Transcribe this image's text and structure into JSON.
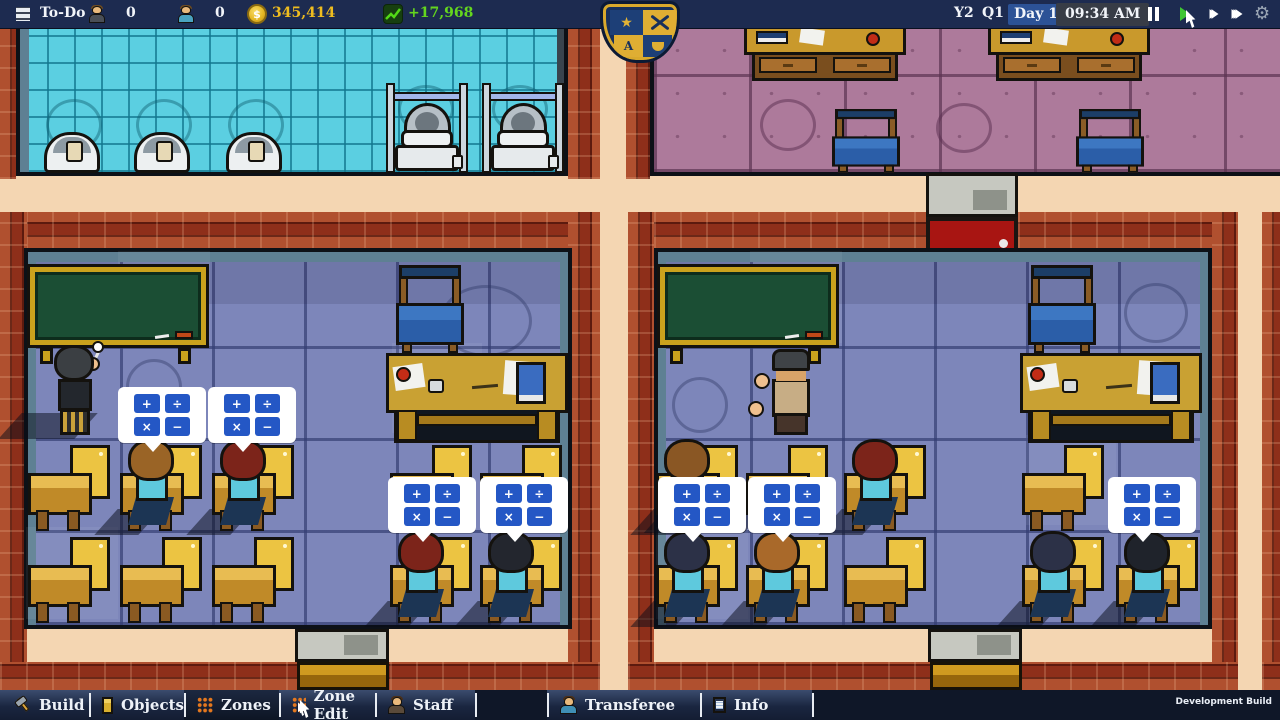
{
  "topbar": {
    "todo_label": "To-Do",
    "teachers_count": "0",
    "students_count": "0",
    "currency_symbol": "$",
    "money": "345,414",
    "income": "+17,968",
    "year": "Y2",
    "quarter": "Q1",
    "day": "Day 1",
    "time": "09:34 AM"
  },
  "toolbar": {
    "active_tab": "Zones",
    "dev_label": "Development Build",
    "tabs": [
      {
        "label": "Build",
        "icon": "hammer-icon"
      },
      {
        "label": "Objects",
        "icon": "cabinet-icon"
      },
      {
        "label": "Zones",
        "icon": "zones-grid-icon"
      },
      {
        "label": "Zone Edit",
        "icon": "zone-edit-icon"
      },
      {
        "label": "Staff",
        "icon": "staff-icon"
      },
      {
        "label": "Transferee",
        "icon": "transferee-icon"
      },
      {
        "label": "Info",
        "icon": "info-icon"
      }
    ]
  },
  "bubble": {
    "symbols": [
      "+",
      "÷",
      "×",
      "−"
    ]
  },
  "crest": {
    "tl_symbol": "★",
    "bl_letter": "A"
  },
  "colors": {
    "topbar_bg": "#1d2b50",
    "money_text": "#eebc1f",
    "income_text": "#64d61e",
    "corridor": "#f4d6b2",
    "brick": "#9c3a22",
    "classroom_floor": "#7d86ba",
    "bathroom_floor": "#5bcfe1",
    "office_floor": "#ad7a9b",
    "bubble_tile": "#2457c5",
    "play_button": "#3ec532"
  }
}
